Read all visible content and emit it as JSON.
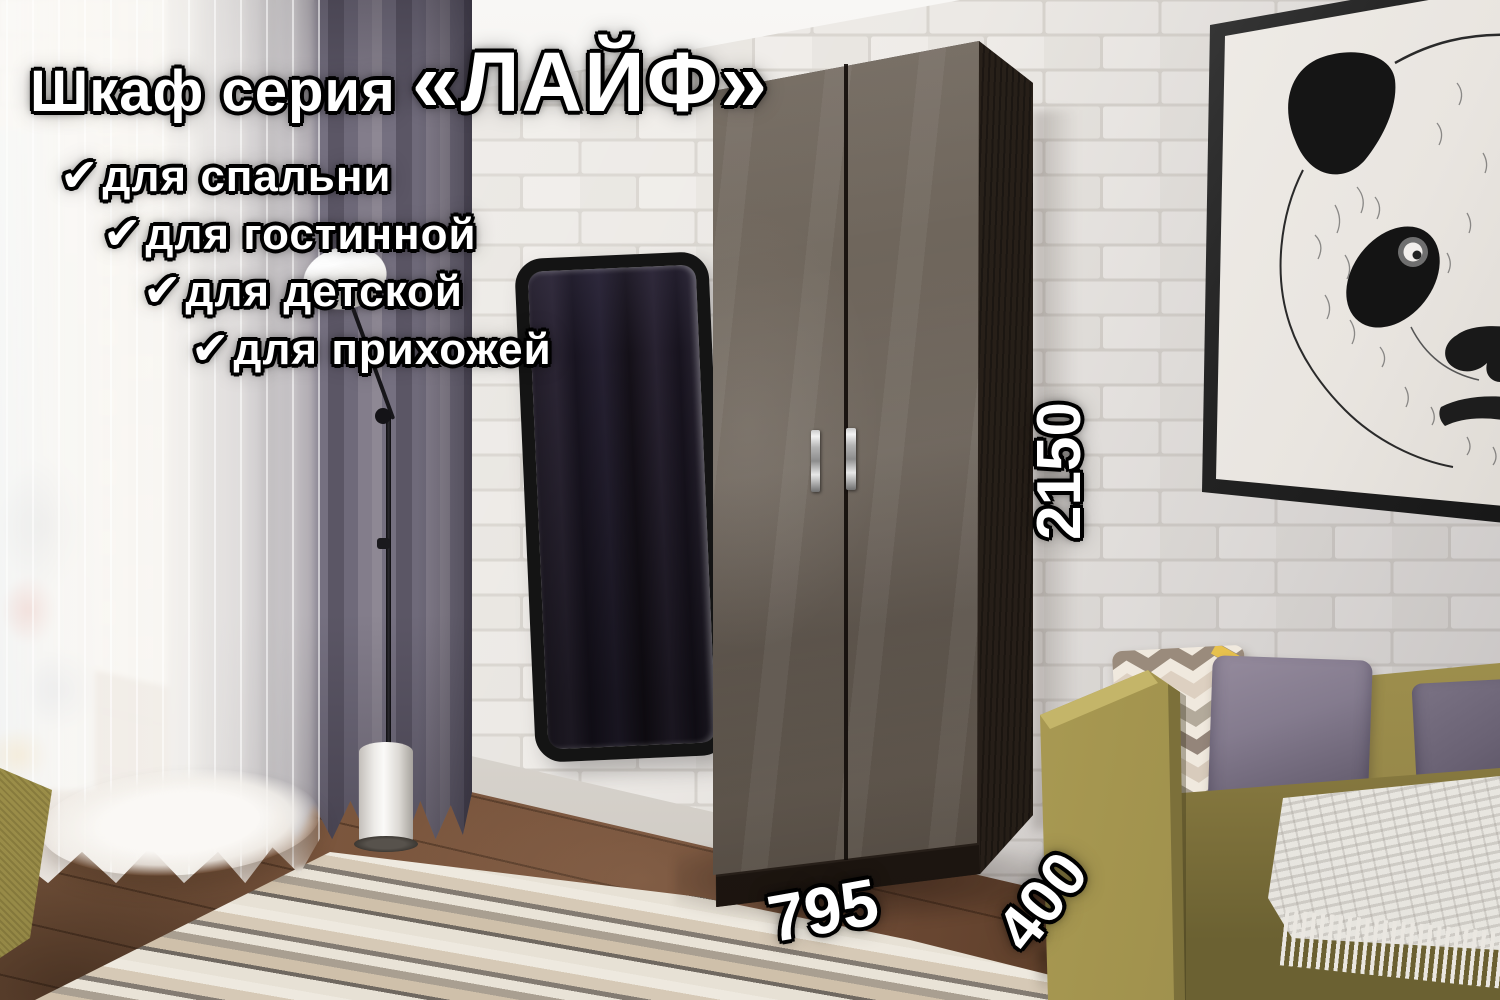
{
  "title": {
    "prefix": "Шкаф серия",
    "series": "«ЛАЙФ»"
  },
  "features": [
    {
      "check": "✔",
      "label": "для спальни"
    },
    {
      "check": "✔",
      "label": "для гостинной"
    },
    {
      "check": "✔",
      "label": "для детской"
    },
    {
      "check": "✔",
      "label": "для прихожей"
    }
  ],
  "dimensions": {
    "height": "2150",
    "width": "795",
    "depth": "400"
  },
  "palette": {
    "text_fill": "#ffffff",
    "text_outline": "#000000",
    "door_gloss": "#6f665c",
    "carcass_wenge": "#271f19",
    "wall_brick": "#ece9e5",
    "curtain_purple": "#8e8894",
    "sofa_olive": "#b0a158",
    "pillow_purple": "#847b8e",
    "floor_wood": "#74523c",
    "frame_black": "#232323"
  }
}
